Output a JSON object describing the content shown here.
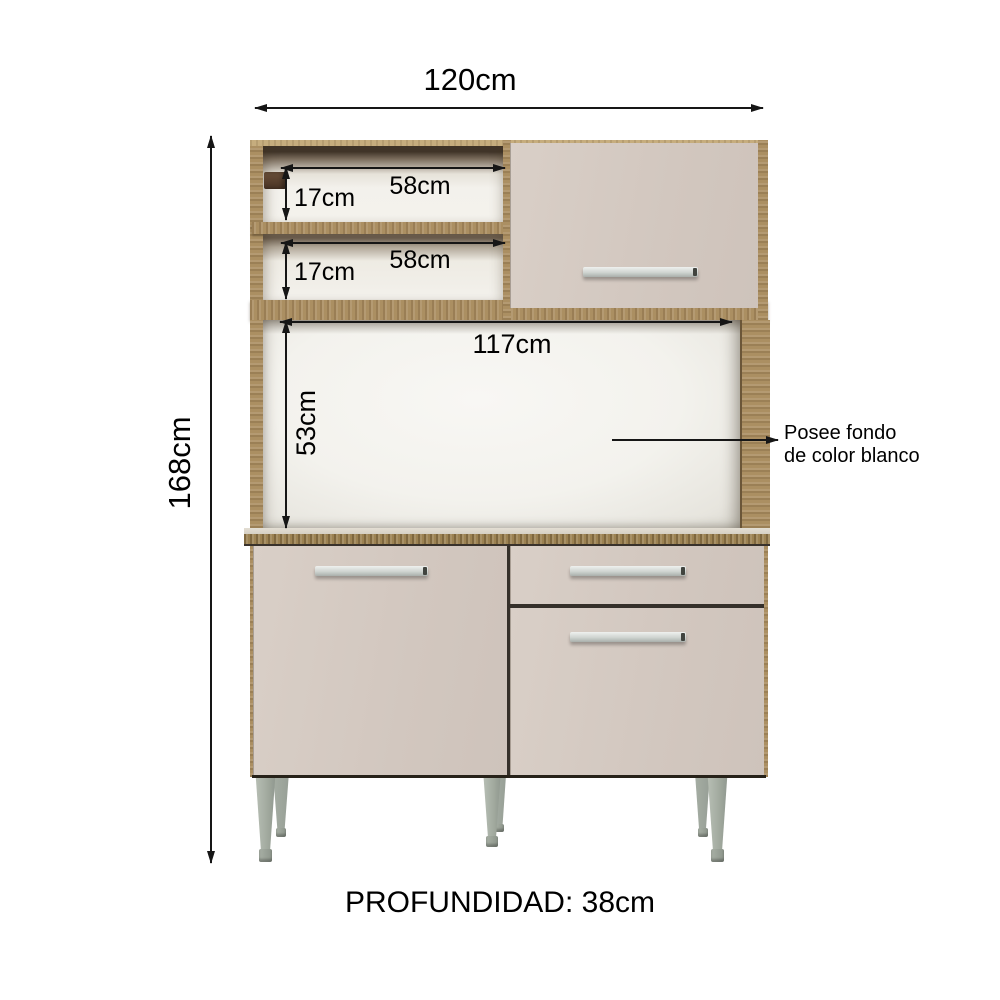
{
  "annotations": {
    "total_width": "120cm",
    "total_height": "168cm",
    "shelf1_width": "58cm",
    "shelf1_height": "17cm",
    "shelf2_width": "58cm",
    "shelf2_height": "17cm",
    "opening_width": "117cm",
    "opening_height": "53cm",
    "depth": "PROFUNDIDAD: 38cm",
    "back_panel_note": {
      "line1": "Posee fondo",
      "line2": "de color blanco"
    }
  },
  "colors": {
    "wood": "#ab8f62",
    "wood_light": "#c6ad7e",
    "wood_dark": "#9c8252",
    "panel": "#d2c7bf",
    "interior": "#f3f1ec",
    "chrome": "#cfd4d0",
    "leg": "#a3aba0",
    "arrow": "#161616",
    "text": "#000000",
    "background": "#ffffff"
  }
}
